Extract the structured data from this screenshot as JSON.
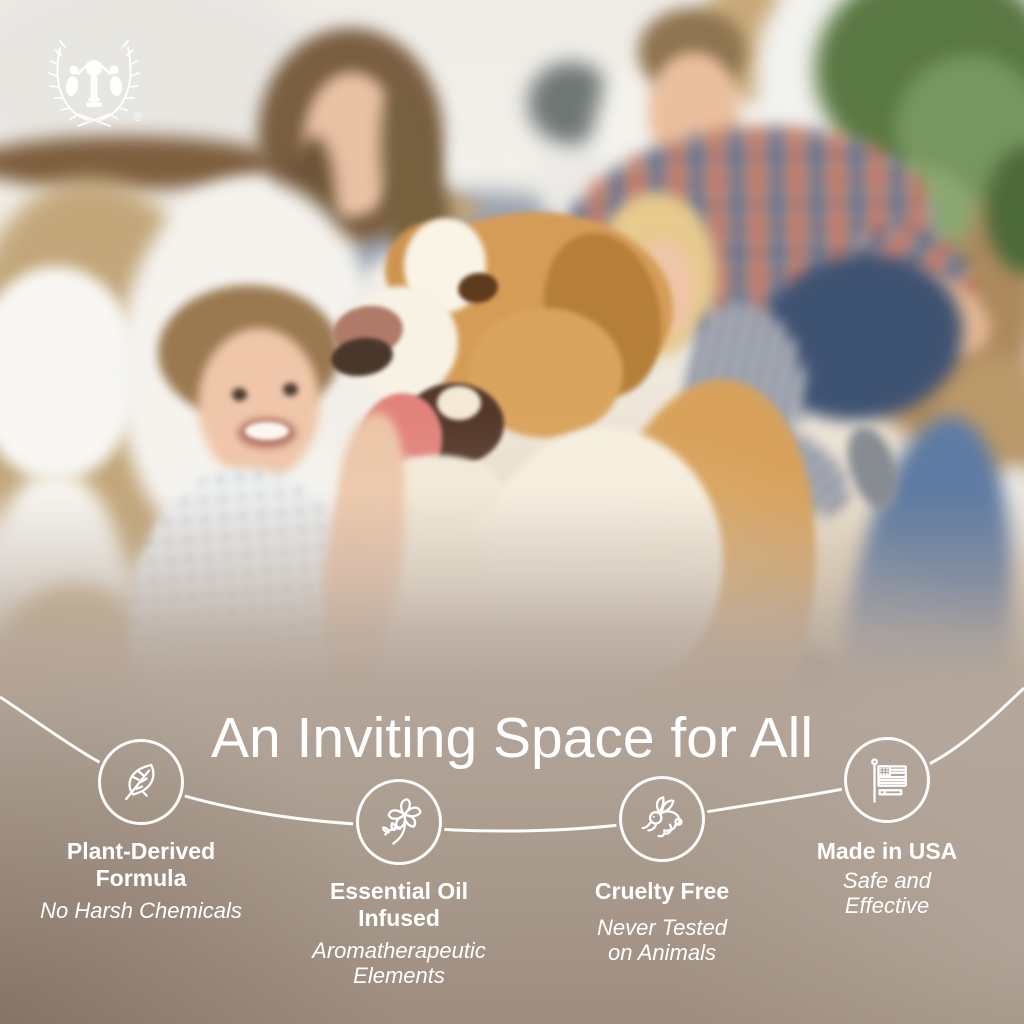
{
  "brand": {
    "logo": "laurel-wreath-children-emblem",
    "registered": "®"
  },
  "headline": "An Inviting Space for All",
  "features": [
    {
      "icon": "leaf-icon",
      "title": "Plant-Derived Formula",
      "title_lines": [
        "Plant-Derived",
        "Formula"
      ],
      "subtitle": "No Harsh Chemicals",
      "subtitle_lines": [
        "No Harsh Chemicals"
      ]
    },
    {
      "icon": "flower-icon",
      "title": "Essential Oil Infused",
      "title_lines": [
        "Essential Oil",
        "Infused"
      ],
      "subtitle": "Aromatherapeutic Elements",
      "subtitle_lines": [
        "Aromatherapeutic",
        "Elements"
      ]
    },
    {
      "icon": "rabbit-icon",
      "title": "Cruelty Free",
      "title_lines": [
        "Cruelty Free"
      ],
      "subtitle": "Never Tested on Animals",
      "subtitle_lines": [
        "Never Tested",
        "on Animals"
      ]
    },
    {
      "icon": "usa-flag-icon",
      "title": "Made in USA",
      "title_lines": [
        "Made in USA"
      ],
      "subtitle": "Safe and Effective",
      "subtitle_lines": [
        "Safe and",
        "Effective"
      ]
    }
  ],
  "colors": {
    "text_white": "#ffffff",
    "connector_line": "#ffffff",
    "taupe_overlay": "#ab9c8e"
  },
  "photo": {
    "description": "Blurred photo of a family of four with a happy tan-and-white dog among cardboard moving boxes in a bright living room"
  }
}
